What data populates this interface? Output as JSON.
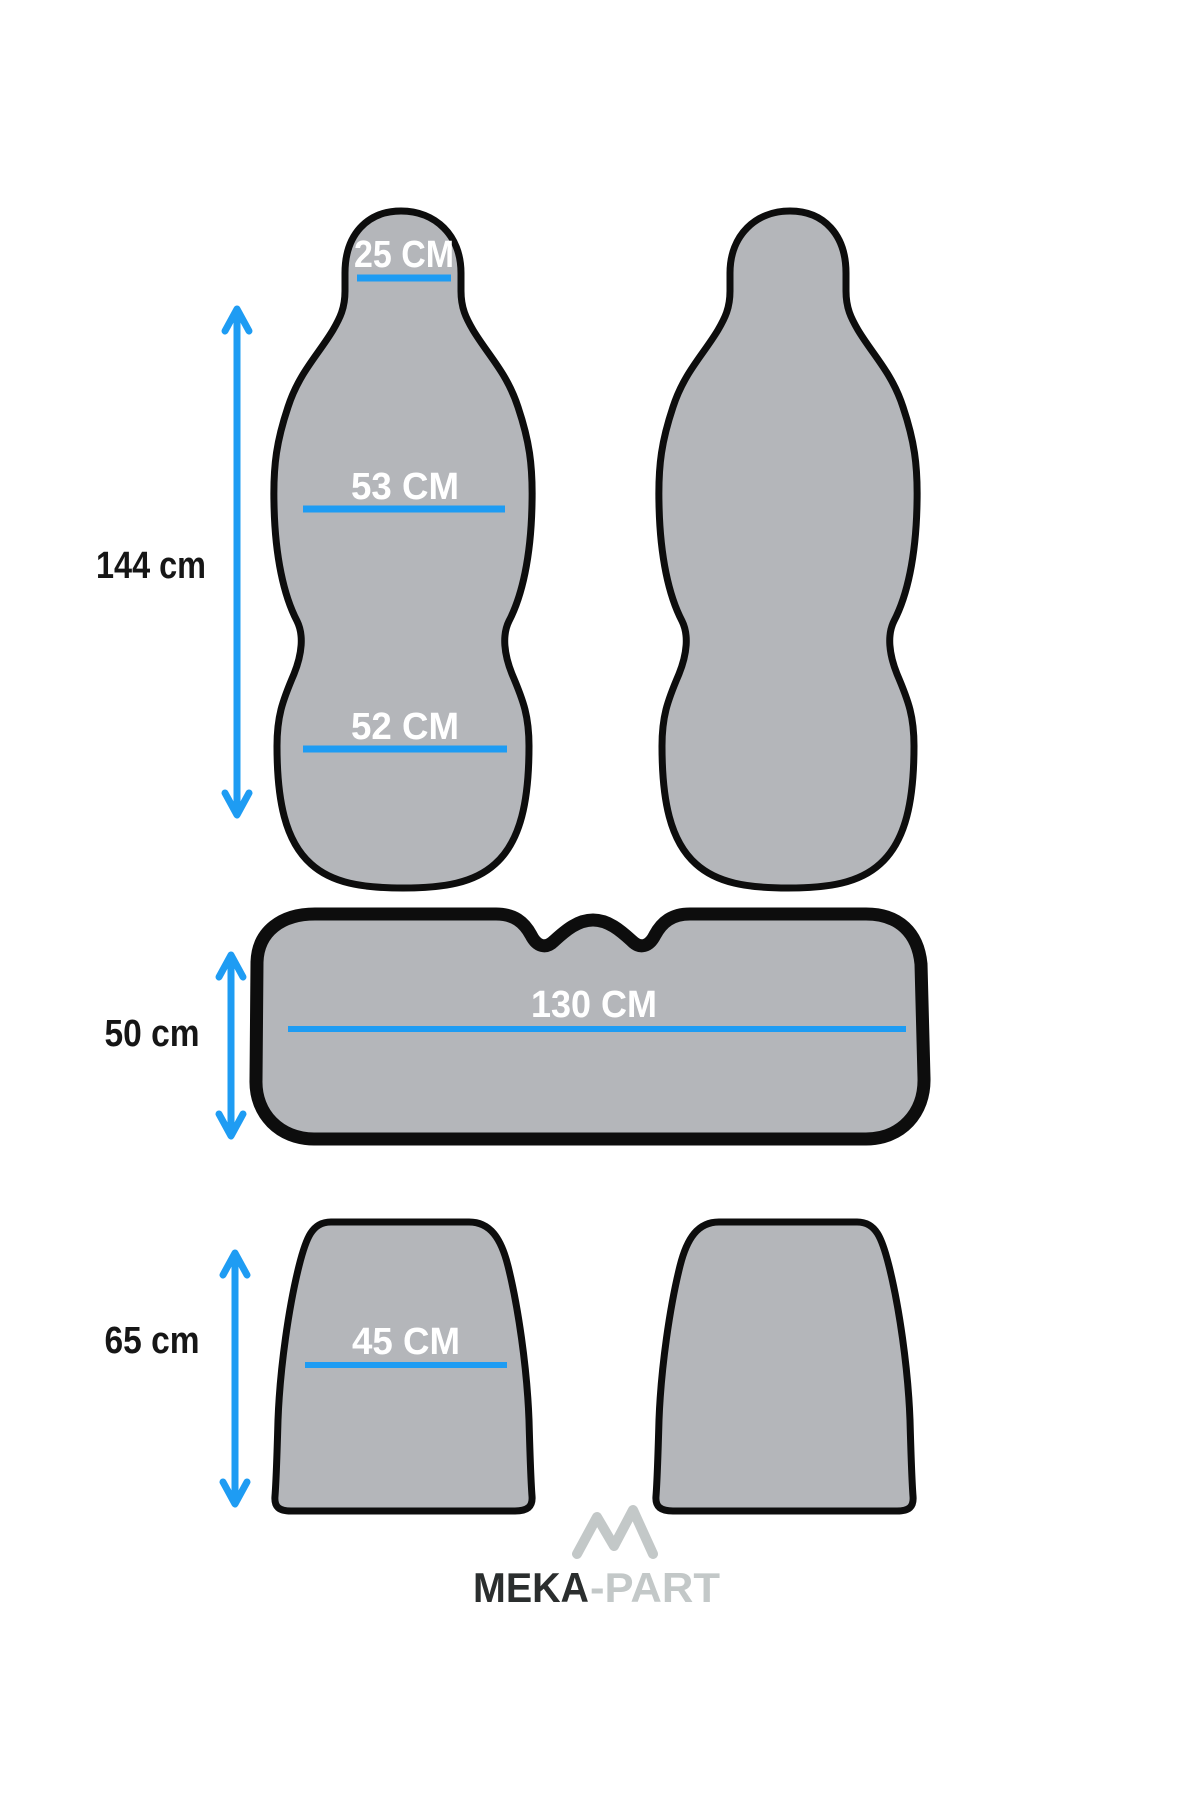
{
  "page": {
    "background_color": "#ffffff",
    "description": "Car seat cover set dimensions diagram"
  },
  "colors": {
    "shape_fill": "#b4b6ba",
    "shape_outline": "#0d0d0d",
    "measure_blue": "#1e9cf3",
    "label_white": "#ffffff",
    "label_black": "#161616",
    "logo_dark": "#2b2e2e",
    "logo_light": "#c3c8c8"
  },
  "diagram": {
    "front_backrest": {
      "headrest_width_label": "25 CM",
      "upper_width_label": "53 CM",
      "lower_width_label": "52 CM",
      "height_label": "144 cm"
    },
    "rear_bench_backrest": {
      "width_label": "130 CM",
      "height_label": "50 cm"
    },
    "rear_cushion": {
      "width_label": "45 CM",
      "height_label": "65 cm"
    }
  },
  "logo": {
    "brand_primary": "MEKA",
    "brand_secondary": "-PART"
  }
}
